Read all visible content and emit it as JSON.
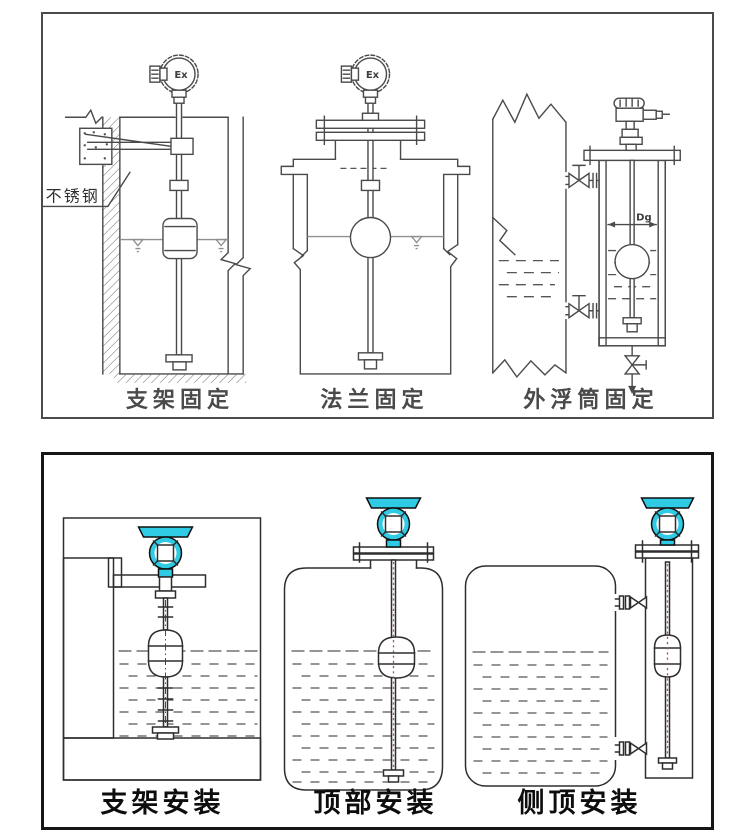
{
  "colors": {
    "line": "#4a4a4a",
    "line_dark": "#2e2e2e",
    "liquid": "#8f8f8f",
    "head_cyan": "#2fcbe4",
    "centerline_red": "#a9584b",
    "label_gray": "#4a4a4a",
    "label_black": "#0d0d0d",
    "panel_border_top": "#4b4b4b",
    "panel_border_bottom": "#161616"
  },
  "top_panel": {
    "labels": {
      "bracket_fixing": "支架固定",
      "flange_fixing": "法兰固定",
      "external_chamber_fixing": "外浮筒固定"
    },
    "annotations": {
      "stainless_steel": "不锈钢",
      "ex_marking": "Ex",
      "dg_marking": "Dg"
    }
  },
  "bottom_panel": {
    "labels": {
      "bracket_install": "支架安装",
      "top_install": "顶部安装",
      "side_top_install": "侧顶安装"
    }
  }
}
